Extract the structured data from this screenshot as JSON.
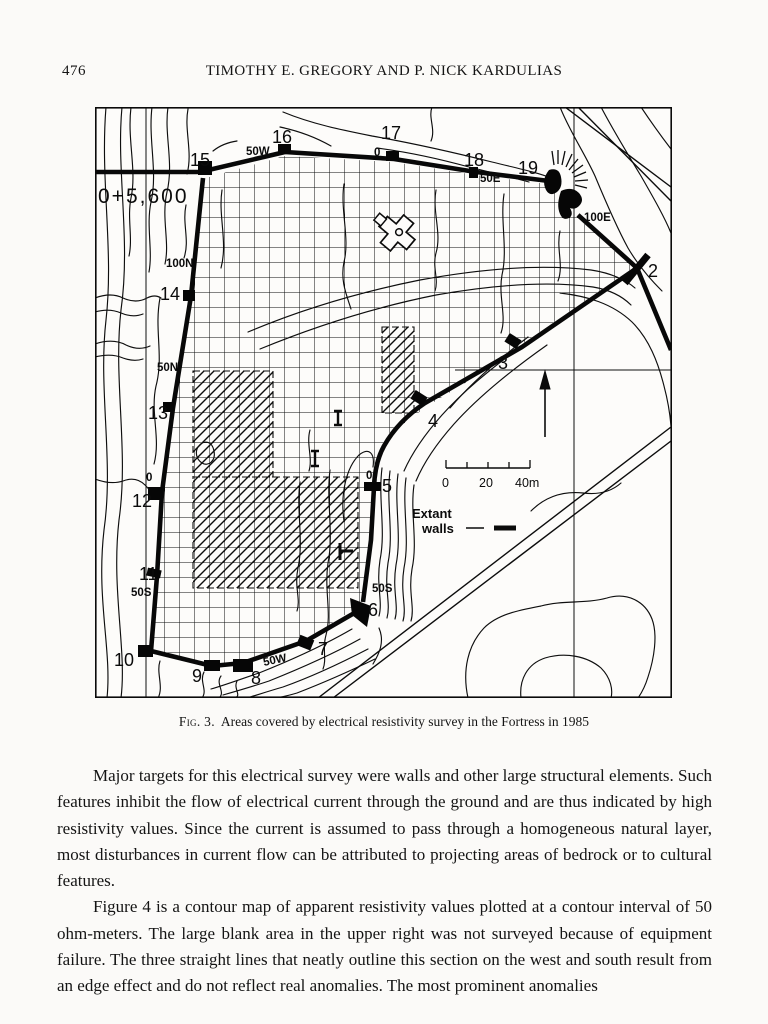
{
  "page": {
    "number": "476",
    "running_title": "TIMOTHY E. GREGORY AND P. NICK KARDULIAS"
  },
  "figure": {
    "caption_label": "Fig. 3.",
    "caption_text": "Areas covered by electrical resistivity survey in the Fortress in 1985",
    "map_labels": {
      "datum": "0+5,600",
      "s2": "2",
      "s3": "3",
      "s4": "4",
      "s5": "5",
      "s6": "6",
      "s7": "7",
      "s8": "8",
      "s9": "9",
      "s10": "10",
      "s11": "11",
      "s12": "12",
      "s13": "13",
      "s14": "14",
      "s15": "15",
      "s16": "16",
      "s17": "17",
      "s18": "18",
      "s19": "19",
      "g50w_top": "50W",
      "g0_top": "0",
      "g50e": "50E",
      "g100e": "100E",
      "g100n": "100N",
      "g50n": "50N",
      "g0_west": "0",
      "g50s_west": "50S",
      "g0_east": "0",
      "g50s_east": "50S",
      "g50w_south": "50W"
    },
    "scale_bar": {
      "t0": "0",
      "t20": "20",
      "t40": "40m"
    },
    "legend": {
      "line1": "Extant",
      "line2": "walls"
    }
  },
  "body": {
    "para1": "Major targets for this electrical survey were walls and other large structural elements. Such features inhibit the flow of electrical current through the ground and are thus indicated by high resistivity values. Since the current is assumed to pass through a homogeneous natural layer, most disturbances in current flow can be attributed to projecting areas of bedrock or to cultural features.",
    "para2": "Figure 4 is a contour map of apparent resistivity values plotted at a contour interval of 50 ohm-meters. The large blank area in the upper right was not surveyed because of equipment failure. The three straight lines that neatly outline this section on the west and south result from an edge effect and do not reflect real anomalies. The most prominent anomalies"
  }
}
